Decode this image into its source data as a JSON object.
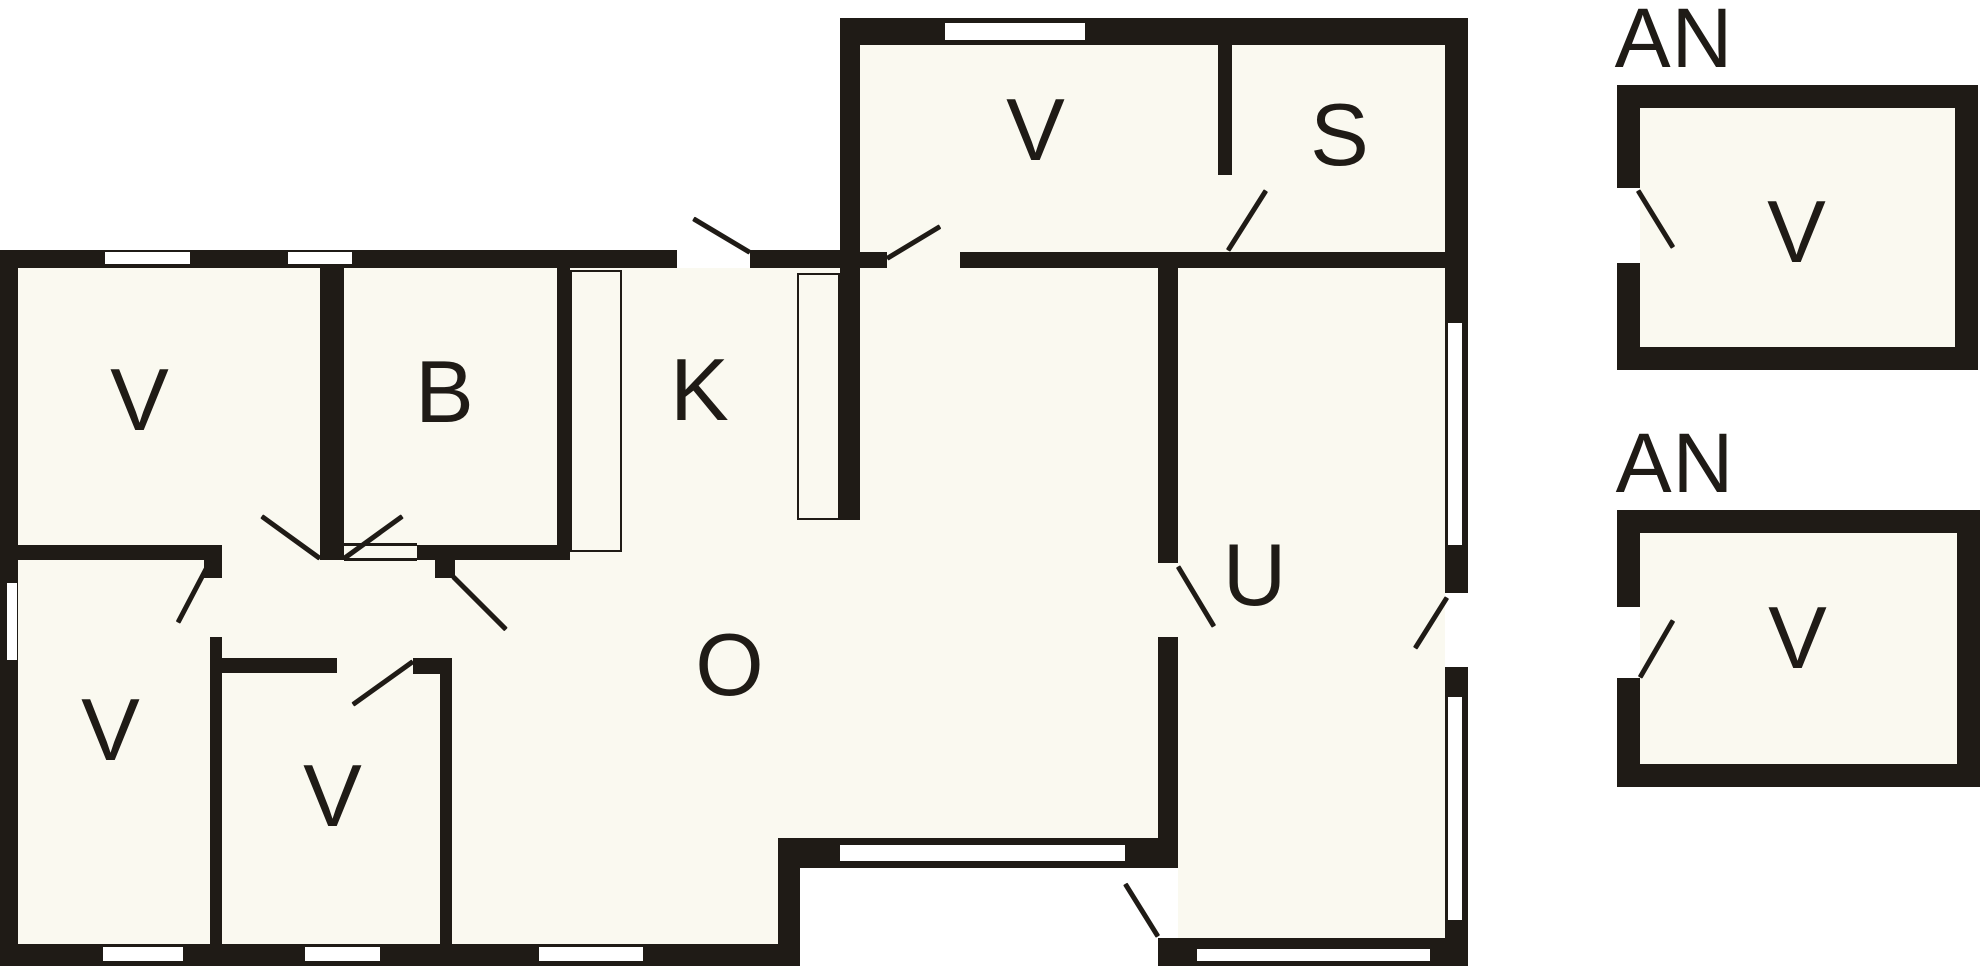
{
  "title": "Floor plan",
  "colors": {
    "wall": "#1f1b16",
    "floor": "#faf9f0",
    "window": "#ffffff",
    "background": "#ffffff"
  },
  "canvas": {
    "width": 1980,
    "height": 966
  },
  "rooms": {
    "main_building": [
      "V",
      "B",
      "K",
      "O",
      "U",
      "S",
      "V",
      "V"
    ],
    "annex_1": {
      "title": "AN",
      "room": "V"
    },
    "annex_2": {
      "title": "AN",
      "room": "V"
    }
  },
  "plan": {
    "floors": [
      {
        "name": "floor-main-center",
        "x": 18,
        "y": 268,
        "w": 1427,
        "h": 600
      },
      {
        "name": "floor-main-lower-left",
        "x": 18,
        "y": 868,
        "w": 782,
        "h": 76
      },
      {
        "name": "floor-u-lower",
        "x": 1178,
        "y": 868,
        "w": 267,
        "h": 76
      },
      {
        "name": "floor-upper-wing",
        "x": 860,
        "y": 45,
        "w": 585,
        "h": 207
      },
      {
        "name": "floor-door-patch",
        "x": 887,
        "y": 252,
        "w": 73,
        "h": 16
      },
      {
        "name": "floor-annex-1",
        "x": 1640,
        "y": 108,
        "w": 315,
        "h": 239
      },
      {
        "name": "floor-annex-2",
        "x": 1640,
        "y": 533,
        "w": 317,
        "h": 231
      }
    ],
    "walls": [
      {
        "name": "left-exterior-wall",
        "x": 0,
        "y": 250,
        "w": 18,
        "h": 716
      },
      {
        "name": "bottom-left-wall",
        "x": 0,
        "y": 944,
        "w": 800,
        "h": 22
      },
      {
        "name": "top-left-wing-wall",
        "x": 0,
        "y": 250,
        "w": 677,
        "h": 18
      },
      {
        "name": "top-left-wing-wall-east",
        "x": 750,
        "y": 250,
        "w": 110,
        "h": 18
      },
      {
        "name": "upper-wing-top-wall",
        "x": 840,
        "y": 18,
        "w": 628,
        "h": 27
      },
      {
        "name": "upper-wing-left-wall",
        "x": 840,
        "y": 18,
        "w": 20,
        "h": 502
      },
      {
        "name": "right-wall-top",
        "x": 1445,
        "y": 18,
        "w": 23,
        "h": 305
      },
      {
        "name": "right-wall-mid1",
        "x": 1445,
        "y": 545,
        "w": 23,
        "h": 48
      },
      {
        "name": "right-wall-mid2",
        "x": 1445,
        "y": 667,
        "w": 23,
        "h": 30
      },
      {
        "name": "right-wall-bottom",
        "x": 1445,
        "y": 920,
        "w": 23,
        "h": 46
      },
      {
        "name": "right-window1-edge-a",
        "x": 1445,
        "y": 323,
        "w": 3,
        "h": 222
      },
      {
        "name": "right-window1-edge-b",
        "x": 1462,
        "y": 323,
        "w": 6,
        "h": 222
      },
      {
        "name": "right-window2-edge-a",
        "x": 1445,
        "y": 697,
        "w": 3,
        "h": 223
      },
      {
        "name": "right-window2-edge-b",
        "x": 1462,
        "y": 697,
        "w": 6,
        "h": 223
      },
      {
        "name": "upper-wing-bottom-wall-stub",
        "x": 860,
        "y": 252,
        "w": 27,
        "h": 16
      },
      {
        "name": "upper-wing-bottom-wall",
        "x": 960,
        "y": 252,
        "w": 485,
        "h": 16
      },
      {
        "name": "vs-partition",
        "x": 1218,
        "y": 45,
        "w": 14,
        "h": 130
      },
      {
        "name": "ou-partition-upper",
        "x": 1158,
        "y": 268,
        "w": 20,
        "h": 295
      },
      {
        "name": "ou-partition-lower",
        "x": 1158,
        "y": 637,
        "w": 20,
        "h": 231
      },
      {
        "name": "ou-corner-post",
        "x": 1158,
        "y": 938,
        "w": 22,
        "h": 28
      },
      {
        "name": "o-bottom-wall",
        "x": 778,
        "y": 838,
        "w": 400,
        "h": 30
      },
      {
        "name": "step-wall",
        "x": 778,
        "y": 838,
        "w": 22,
        "h": 106
      },
      {
        "name": "u-bottom-wall",
        "x": 1158,
        "y": 938,
        "w": 310,
        "h": 28
      },
      {
        "name": "hall-wall-west",
        "x": 18,
        "y": 545,
        "w": 194,
        "h": 15
      },
      {
        "name": "hall-door-post-a",
        "x": 204,
        "y": 545,
        "w": 18,
        "h": 33
      },
      {
        "name": "hall-wall-east",
        "x": 417,
        "y": 545,
        "w": 140,
        "h": 15
      },
      {
        "name": "hall-door-post-b",
        "x": 435,
        "y": 560,
        "w": 20,
        "h": 18
      },
      {
        "name": "vb-partition",
        "x": 320,
        "y": 268,
        "w": 24,
        "h": 292
      },
      {
        "name": "b-room-east-wall",
        "x": 557,
        "y": 268,
        "w": 13,
        "h": 292
      },
      {
        "name": "lower-v-east-wall",
        "x": 210,
        "y": 637,
        "w": 12,
        "h": 307
      },
      {
        "name": "small-v-top-wall",
        "x": 222,
        "y": 658,
        "w": 115,
        "h": 15
      },
      {
        "name": "small-v-corner-post",
        "x": 413,
        "y": 658,
        "w": 39,
        "h": 16
      },
      {
        "name": "small-v-east-wall",
        "x": 440,
        "y": 658,
        "w": 12,
        "h": 286
      },
      {
        "name": "annex1-top-wall",
        "x": 1617,
        "y": 85,
        "w": 361,
        "h": 23
      },
      {
        "name": "annex1-bottom-wall",
        "x": 1617,
        "y": 347,
        "w": 361,
        "h": 23
      },
      {
        "name": "annex1-left-wall-upper",
        "x": 1617,
        "y": 85,
        "w": 23,
        "h": 103
      },
      {
        "name": "annex1-left-wall-lower",
        "x": 1617,
        "y": 263,
        "w": 23,
        "h": 107
      },
      {
        "name": "annex1-right-wall",
        "x": 1955,
        "y": 85,
        "w": 23,
        "h": 285
      },
      {
        "name": "annex2-top-wall",
        "x": 1617,
        "y": 510,
        "w": 363,
        "h": 23
      },
      {
        "name": "annex2-bottom-wall",
        "x": 1617,
        "y": 764,
        "w": 363,
        "h": 23
      },
      {
        "name": "annex2-left-wall-upper",
        "x": 1617,
        "y": 510,
        "w": 23,
        "h": 97
      },
      {
        "name": "annex2-left-wall-lower",
        "x": 1617,
        "y": 678,
        "w": 23,
        "h": 109
      },
      {
        "name": "annex2-right-wall",
        "x": 1957,
        "y": 510,
        "w": 23,
        "h": 277
      }
    ],
    "windows": [
      {
        "name": "window-top-left-1",
        "x": 105,
        "y": 252,
        "w": 85,
        "h": 12
      },
      {
        "name": "window-top-left-2",
        "x": 288,
        "y": 252,
        "w": 64,
        "h": 12
      },
      {
        "name": "window-upper-top",
        "x": 945,
        "y": 23,
        "w": 140,
        "h": 17
      },
      {
        "name": "window-left-wall",
        "x": 7,
        "y": 583,
        "w": 10,
        "h": 77
      },
      {
        "name": "window-bottom-1",
        "x": 103,
        "y": 947,
        "w": 80,
        "h": 14
      },
      {
        "name": "window-bottom-2",
        "x": 305,
        "y": 947,
        "w": 75,
        "h": 14
      },
      {
        "name": "window-bottom-3",
        "x": 539,
        "y": 947,
        "w": 104,
        "h": 14
      },
      {
        "name": "window-o-bottom",
        "x": 840,
        "y": 845,
        "w": 285,
        "h": 16
      },
      {
        "name": "window-u-bottom",
        "x": 1197,
        "y": 949,
        "w": 233,
        "h": 12
      },
      {
        "name": "window-right-1",
        "x": 1448,
        "y": 323,
        "w": 14,
        "h": 222
      },
      {
        "name": "window-right-2",
        "x": 1448,
        "y": 697,
        "w": 14,
        "h": 223
      }
    ],
    "fixtures": [
      {
        "name": "fixture-kitchen-west",
        "x": 570,
        "y": 270,
        "w": 52,
        "h": 282
      },
      {
        "name": "fixture-kitchen-east",
        "x": 797,
        "y": 273,
        "w": 43,
        "h": 247
      }
    ],
    "thin_lines": [
      {
        "name": "passage-edge-top",
        "x": 344,
        "y": 543,
        "w": 73,
        "h": 3
      },
      {
        "name": "passage-edge-bottom",
        "x": 344,
        "y": 558,
        "w": 73,
        "h": 3
      }
    ],
    "door_swings": [
      {
        "name": "door-swing-kitchen-exterior",
        "x1": 750,
        "y1": 252,
        "x2": 693,
        "y2": 218
      },
      {
        "name": "door-swing-upper-v",
        "x1": 887,
        "y1": 258,
        "x2": 940,
        "y2": 226
      },
      {
        "name": "door-swing-s-room",
        "x1": 1228,
        "y1": 250,
        "x2": 1266,
        "y2": 190
      },
      {
        "name": "door-swing-u-room",
        "x1": 1178,
        "y1": 566,
        "x2": 1214,
        "y2": 626
      },
      {
        "name": "door-swing-right-exterior",
        "x1": 1447,
        "y1": 597,
        "x2": 1415,
        "y2": 648
      },
      {
        "name": "door-swing-porch",
        "x1": 1158,
        "y1": 936,
        "x2": 1125,
        "y2": 883
      },
      {
        "name": "door-swing-hall-to-v",
        "x1": 320,
        "y1": 558,
        "x2": 262,
        "y2": 516
      },
      {
        "name": "door-swing-hall-to-b",
        "x1": 344,
        "y1": 558,
        "x2": 402,
        "y2": 516
      },
      {
        "name": "door-swing-hall-to-lower-v",
        "x1": 210,
        "y1": 561,
        "x2": 178,
        "y2": 622
      },
      {
        "name": "door-swing-passage",
        "x1": 453,
        "y1": 576,
        "x2": 506,
        "y2": 629
      },
      {
        "name": "door-swing-small-v",
        "x1": 413,
        "y1": 661,
        "x2": 353,
        "y2": 704
      },
      {
        "name": "door-swing-annex1",
        "x1": 1638,
        "y1": 190,
        "x2": 1673,
        "y2": 247
      },
      {
        "name": "door-swing-annex2",
        "x1": 1640,
        "y1": 677,
        "x2": 1673,
        "y2": 620
      }
    ],
    "labels": [
      {
        "name": "room-label-v-upper-left",
        "x": 140,
        "y": 400,
        "text": "V",
        "cls": ""
      },
      {
        "name": "room-label-b",
        "x": 445,
        "y": 392,
        "text": "B",
        "cls": ""
      },
      {
        "name": "room-label-k",
        "x": 700,
        "y": 390,
        "text": "K",
        "cls": ""
      },
      {
        "name": "room-label-v-upper-wing",
        "x": 1036,
        "y": 130,
        "text": "V",
        "cls": ""
      },
      {
        "name": "room-label-s",
        "x": 1340,
        "y": 135,
        "text": "S",
        "cls": ""
      },
      {
        "name": "room-label-o",
        "x": 730,
        "y": 665,
        "text": "O",
        "cls": ""
      },
      {
        "name": "room-label-u",
        "x": 1255,
        "y": 575,
        "text": "U",
        "cls": ""
      },
      {
        "name": "room-label-v-lower-left",
        "x": 111,
        "y": 730,
        "text": "V",
        "cls": ""
      },
      {
        "name": "room-label-v-small",
        "x": 333,
        "y": 796,
        "text": "V",
        "cls": ""
      },
      {
        "name": "annex1-title",
        "x": 1674,
        "y": 38,
        "text": "AN",
        "cls": "an-label"
      },
      {
        "name": "room-label-v-annex1",
        "x": 1797,
        "y": 232,
        "text": "V",
        "cls": ""
      },
      {
        "name": "annex2-title",
        "x": 1675,
        "y": 463,
        "text": "AN",
        "cls": "an-label"
      },
      {
        "name": "room-label-v-annex2",
        "x": 1798,
        "y": 638,
        "text": "V",
        "cls": ""
      }
    ]
  }
}
